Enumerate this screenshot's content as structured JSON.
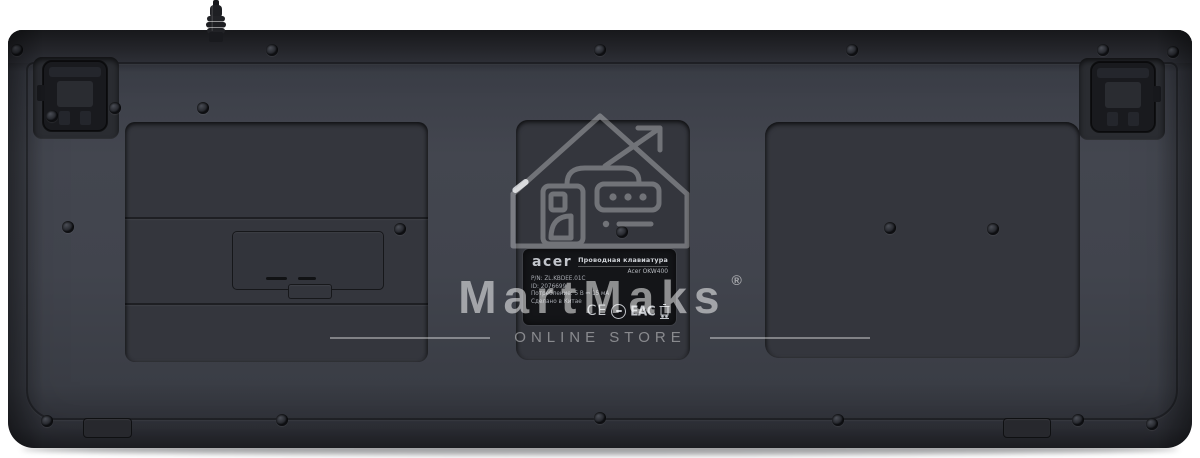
{
  "product": {
    "watermark": {
      "brand": "MartMaks",
      "registered": "®",
      "subtitle": "ONLINE STORE"
    },
    "label": {
      "brand": "acer",
      "type": "Проводная клавиатура",
      "model": "Acer OKW400",
      "lines": {
        "pn": "P/N: ZL.KBDEE.01C",
        "id": "ID: 2076699",
        "power": "Потребление: 5 В ⎓ 15 мА",
        "origin": "Сделано в Китае"
      },
      "marks": {
        "ce": "CE",
        "eac": "EAC"
      }
    },
    "icons": {
      "cert_circle": "certification-circle",
      "weee": "weee-crossed-out-bin",
      "house_logo": "storefront-house-with-arrow",
      "feet": "flip-out-tilt-foot",
      "cable": "usb-cable-strain-relief"
    },
    "colors": {
      "body": "#41444d",
      "top_edge": "#1b1c20",
      "panel": "#34363d",
      "label_bg": "#141518",
      "label_text": "#b2b5bc",
      "watermark": "#ffffff",
      "background": "#ffffff"
    }
  }
}
